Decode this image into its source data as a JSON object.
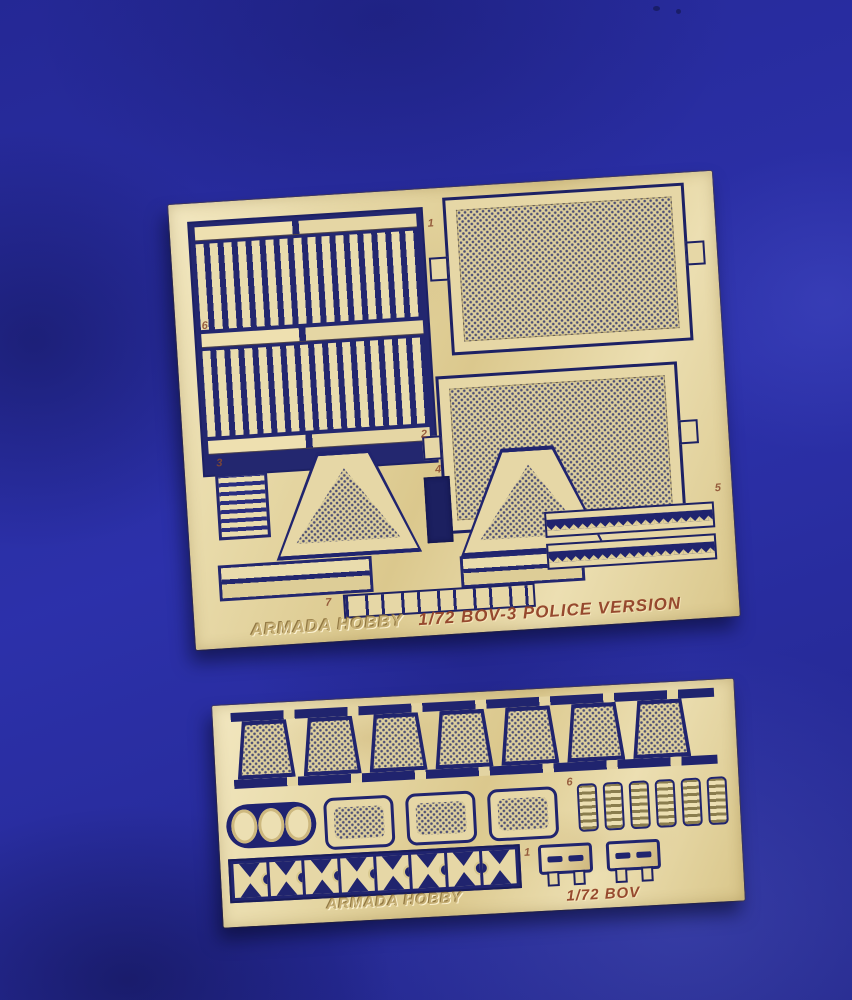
{
  "colors": {
    "fabric_blue": "#2a2ea6",
    "fabric_shadow": "#191c6b",
    "fabric_highlight": "#5560d4",
    "brass_light": "#f2e7c0",
    "brass": "#e3d4a2",
    "brass_dark": "#c9b273",
    "cutout_navy": "#20246e",
    "etch_brown": "#96492e"
  },
  "top_fret": {
    "brand": "ARMADA HOBBY",
    "title": "1/72 BOV-3 POLICE VERSION",
    "labels": {
      "p1": "1",
      "p2": "2",
      "p3": "3",
      "p4": "4",
      "p5": "5",
      "p6": "6",
      "p7": "7"
    }
  },
  "bottom_fret": {
    "brand": "ARMADA HOBBY",
    "title": "1/72 BOV",
    "labels": {
      "p6": "6",
      "p1": "1"
    }
  }
}
